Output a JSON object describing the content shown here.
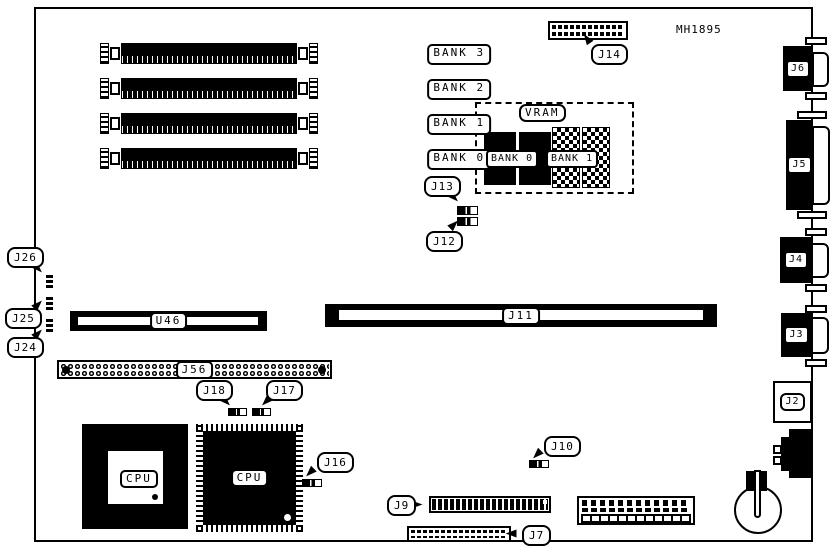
{
  "figure": {
    "part_number": "MH1895"
  },
  "memory": {
    "simm_banks": [
      {
        "label": "BANK 3"
      },
      {
        "label": "BANK 2"
      },
      {
        "label": "BANK 1"
      },
      {
        "label": "BANK 0"
      }
    ]
  },
  "vram": {
    "title": "VRAM",
    "banks": [
      {
        "label": "BANK 0"
      },
      {
        "label": "BANK 1"
      }
    ]
  },
  "chips": {
    "u46": "U46",
    "cpu_socket": "CPU",
    "cpu_qfp": "CPU"
  },
  "slots": {
    "j11": "J11",
    "j56": "J56"
  },
  "callouts": {
    "j14": "J14",
    "j13": "J13",
    "j12": "J12",
    "j26": "J26",
    "j25": "J25",
    "j24": "J24",
    "j18": "J18",
    "j17": "J17",
    "j16": "J16",
    "j10": "J10",
    "j9": "J9",
    "j7": "J7"
  },
  "edge_connectors": {
    "j6": "J6",
    "j5": "J5",
    "j4": "J4",
    "j3": "J3",
    "j2": "J2"
  }
}
